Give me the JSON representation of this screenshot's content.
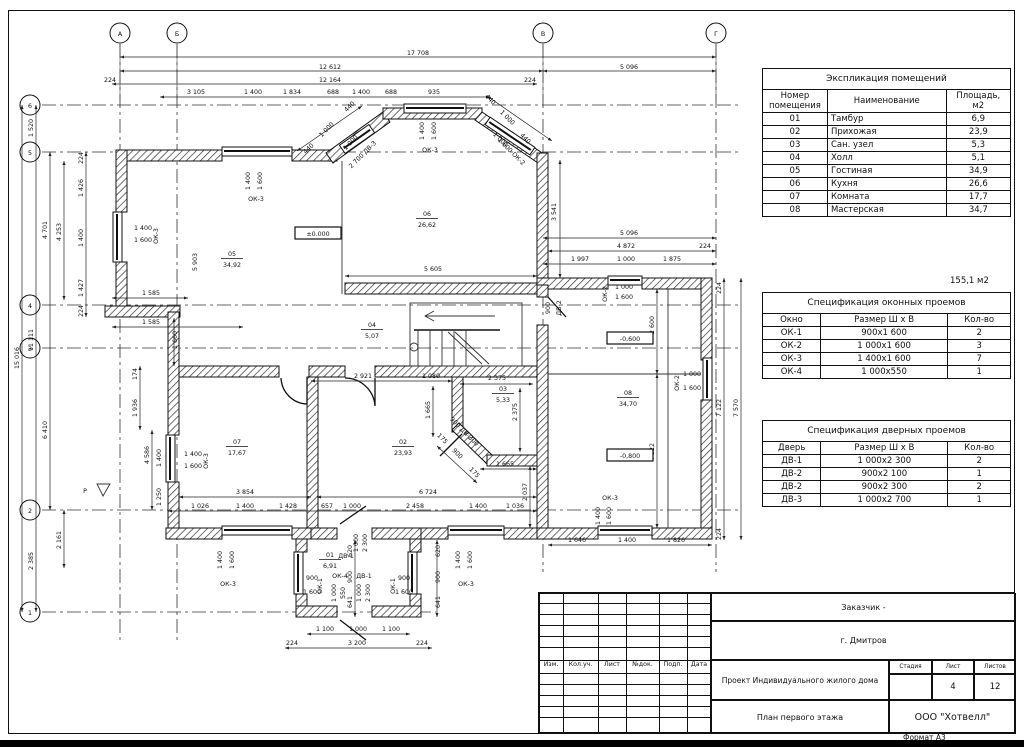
{
  "meta": {
    "format_label": "Формат А3"
  },
  "tables": {
    "rooms": {
      "title": "Экспликация помещений",
      "headers": [
        "Номер помещения",
        "Наименование",
        "Площадь, м2"
      ],
      "rows": [
        [
          "01",
          "Тамбур",
          "6,9"
        ],
        [
          "02",
          "Прихожая",
          "23,9"
        ],
        [
          "03",
          "Сан. узел",
          "5,3"
        ],
        [
          "04",
          "Холл",
          "5,1"
        ],
        [
          "05",
          "Гостиная",
          "34,9"
        ],
        [
          "06",
          "Кухня",
          "26,6"
        ],
        [
          "07",
          "Комната",
          "17,7"
        ],
        [
          "08",
          "Мастерская",
          "34,7"
        ]
      ],
      "total": "155,1 м2"
    },
    "windows": {
      "title": "Спецификация оконных проемов",
      "headers": [
        "Окно",
        "Размер Ш х В",
        "Кол-во"
      ],
      "rows": [
        [
          "ОК-1",
          "900х1 600",
          "2"
        ],
        [
          "ОК-2",
          "1 000х1 600",
          "3"
        ],
        [
          "ОК-3",
          "1 400х1 600",
          "7"
        ],
        [
          "ОК-4",
          "1 000х550",
          "1"
        ]
      ]
    },
    "doors": {
      "title": "Спецификация дверных проемов",
      "headers": [
        "Дверь",
        "Размер Ш х В",
        "Кол-во"
      ],
      "rows": [
        [
          "ДВ-1",
          "1 000х2 300",
          "2"
        ],
        [
          "ДВ-2",
          "900х2 100",
          "1"
        ],
        [
          "ДВ-2",
          "900х2 300",
          "2"
        ],
        [
          "ДВ-3",
          "1 000х2 700",
          "1"
        ]
      ]
    }
  },
  "titleblock": {
    "customer": "Заказчик -",
    "city": "г. Дмитров",
    "project": "Проект Индивидуального жилого дома",
    "sheet_title": "План первого этажа",
    "company": "ООО \"Хотвелл\"",
    "rev_cols": [
      "Изм.",
      "Кол.уч.",
      "Лист",
      "№док.",
      "Подп.",
      "Дата"
    ],
    "stage_headers": [
      "Стадия",
      "Лист",
      "Листов"
    ],
    "stage": "",
    "sheet_no": "4",
    "sheets_total": "12"
  },
  "plan": {
    "labels": [
      {
        "t": "А",
        "x": 120,
        "y": 36,
        "fs": 7.5
      },
      {
        "t": "Б",
        "x": 177,
        "y": 36,
        "fs": 7.5
      },
      {
        "t": "В",
        "x": 543,
        "y": 36,
        "fs": 7.5
      },
      {
        "t": "Г",
        "x": 716,
        "y": 36,
        "fs": 7.5
      },
      {
        "t": "6",
        "x": 30,
        "y": 108,
        "fs": 7.5
      },
      {
        "t": "5",
        "x": 30,
        "y": 155,
        "fs": 7.5
      },
      {
        "t": "4",
        "x": 30,
        "y": 308,
        "fs": 7.5
      },
      {
        "t": "3",
        "x": 30,
        "y": 351,
        "fs": 7.5
      },
      {
        "t": "2",
        "x": 30,
        "y": 513,
        "fs": 7.5
      },
      {
        "t": "1",
        "x": 30,
        "y": 615,
        "fs": 7.5
      },
      {
        "t": "17 708",
        "x": 418,
        "y": 55
      },
      {
        "t": "12 612",
        "x": 330,
        "y": 69
      },
      {
        "t": "5 096",
        "x": 629,
        "y": 69
      },
      {
        "t": "224",
        "x": 110,
        "y": 82
      },
      {
        "t": "12 164",
        "x": 330,
        "y": 82
      },
      {
        "t": "224",
        "x": 530,
        "y": 82
      },
      {
        "t": "3 105",
        "x": 196,
        "y": 94
      },
      {
        "t": "1 400",
        "x": 253,
        "y": 94
      },
      {
        "t": "1 834",
        "x": 292,
        "y": 94
      },
      {
        "t": "688",
        "x": 333,
        "y": 94
      },
      {
        "t": "1 400",
        "x": 361,
        "y": 94
      },
      {
        "t": "688",
        "x": 391,
        "y": 94
      },
      {
        "t": "935",
        "x": 434,
        "y": 94
      },
      {
        "t": "1 520",
        "x": 33,
        "y": 128,
        "r": -90
      },
      {
        "t": "15 016",
        "x": 19,
        "y": 358,
        "r": -90
      },
      {
        "t": "11 111",
        "x": 33,
        "y": 340,
        "r": -90
      },
      {
        "t": "4 701",
        "x": 47,
        "y": 230,
        "r": -90
      },
      {
        "t": "6 410",
        "x": 47,
        "y": 430,
        "r": -90
      },
      {
        "t": "2 385",
        "x": 33,
        "y": 561,
        "r": -90
      },
      {
        "t": "2 161",
        "x": 61,
        "y": 540,
        "r": -90
      },
      {
        "t": "4 253",
        "x": 61,
        "y": 232,
        "r": -90
      },
      {
        "t": "224",
        "x": 83,
        "y": 158,
        "r": -90
      },
      {
        "t": "1 426",
        "x": 83,
        "y": 188,
        "r": -90
      },
      {
        "t": "1 400",
        "x": 83,
        "y": 238,
        "r": -90
      },
      {
        "t": "1 427",
        "x": 83,
        "y": 288,
        "r": -90
      },
      {
        "t": "224",
        "x": 83,
        "y": 311,
        "r": -90
      },
      {
        "t": "1 585",
        "x": 151,
        "y": 295
      },
      {
        "t": "1 585",
        "x": 151,
        "y": 324
      },
      {
        "t": "5 903",
        "x": 197,
        "y": 262,
        "r": -90
      },
      {
        "t": "1 660",
        "x": 177,
        "y": 340,
        "r": -90
      },
      {
        "t": "174",
        "x": 137,
        "y": 374,
        "r": -90
      },
      {
        "t": "1 936",
        "x": 137,
        "y": 408,
        "r": -90
      },
      {
        "t": "4 586",
        "x": 149,
        "y": 455,
        "r": -90
      },
      {
        "t": "1 400",
        "x": 161,
        "y": 458,
        "r": -90
      },
      {
        "t": "1 250",
        "x": 161,
        "y": 497,
        "r": -90
      },
      {
        "t": "3 541",
        "x": 556,
        "y": 212,
        "r": -90
      },
      {
        "t": "5 096",
        "x": 629,
        "y": 235
      },
      {
        "t": "4 872",
        "x": 626,
        "y": 248
      },
      {
        "t": "224",
        "x": 705,
        "y": 248
      },
      {
        "t": "1 997",
        "x": 580,
        "y": 261
      },
      {
        "t": "1 000",
        "x": 626,
        "y": 261
      },
      {
        "t": "1 875",
        "x": 672,
        "y": 261
      },
      {
        "t": "2 600",
        "x": 654,
        "y": 325,
        "r": -90
      },
      {
        "t": "4 522",
        "x": 654,
        "y": 452,
        "r": -90
      },
      {
        "t": "7 122",
        "x": 721,
        "y": 408,
        "r": -90
      },
      {
        "t": "7 570",
        "x": 738,
        "y": 408,
        "r": -90
      },
      {
        "t": "224",
        "x": 721,
        "y": 288,
        "r": -90
      },
      {
        "t": "224",
        "x": 721,
        "y": 534,
        "r": -90
      },
      {
        "t": "1 646",
        "x": 577,
        "y": 542
      },
      {
        "t": "1 400",
        "x": 627,
        "y": 542
      },
      {
        "t": "1 826",
        "x": 676,
        "y": 542
      },
      {
        "t": "5 605",
        "x": 433,
        "y": 271
      },
      {
        "t": "2 921",
        "x": 363,
        "y": 378
      },
      {
        "t": "1 080",
        "x": 431,
        "y": 378
      },
      {
        "t": "1 665",
        "x": 430,
        "y": 410,
        "r": -90
      },
      {
        "t": "2 375",
        "x": 497,
        "y": 380
      },
      {
        "t": "2 375",
        "x": 517,
        "y": 412,
        "r": -90
      },
      {
        "t": "1 665",
        "x": 505,
        "y": 466
      },
      {
        "t": "2 037",
        "x": 527,
        "y": 492,
        "r": -90
      },
      {
        "t": "3 854",
        "x": 245,
        "y": 494
      },
      {
        "t": "6 724",
        "x": 428,
        "y": 494
      },
      {
        "t": "1 026",
        "x": 200,
        "y": 508
      },
      {
        "t": "1 400",
        "x": 245,
        "y": 508
      },
      {
        "t": "1 428",
        "x": 288,
        "y": 508
      },
      {
        "t": "657",
        "x": 327,
        "y": 508
      },
      {
        "t": "1 000",
        "x": 352,
        "y": 508
      },
      {
        "t": "2 458",
        "x": 415,
        "y": 508
      },
      {
        "t": "1 400",
        "x": 478,
        "y": 508
      },
      {
        "t": "1 036",
        "x": 515,
        "y": 508
      },
      {
        "t": "620",
        "x": 352,
        "y": 551,
        "r": -90
      },
      {
        "t": "900",
        "x": 352,
        "y": 577,
        "r": -90
      },
      {
        "t": "641",
        "x": 352,
        "y": 602,
        "r": -90
      },
      {
        "t": "620",
        "x": 440,
        "y": 551,
        "r": -90
      },
      {
        "t": "900",
        "x": 440,
        "y": 577,
        "r": -90
      },
      {
        "t": "641",
        "x": 440,
        "y": 602,
        "r": -90
      },
      {
        "t": "1 100",
        "x": 325,
        "y": 631
      },
      {
        "t": "1 000",
        "x": 358,
        "y": 631
      },
      {
        "t": "1 100",
        "x": 391,
        "y": 631
      },
      {
        "t": "224",
        "x": 292,
        "y": 645
      },
      {
        "t": "3 200",
        "x": 357,
        "y": 645
      },
      {
        "t": "224",
        "x": 422,
        "y": 645
      },
      {
        "t": "05",
        "x": 232,
        "y": 256,
        "fs": 7.5,
        "u": 1
      },
      {
        "t": "34,92",
        "x": 232,
        "y": 267,
        "fs": 7.5
      },
      {
        "t": "06",
        "x": 427,
        "y": 216,
        "fs": 7.5,
        "u": 1
      },
      {
        "t": "26,62",
        "x": 427,
        "y": 227,
        "fs": 7.5
      },
      {
        "t": "04",
        "x": 372,
        "y": 327,
        "fs": 7.5,
        "u": 1
      },
      {
        "t": "5,07",
        "x": 372,
        "y": 338,
        "fs": 7.5
      },
      {
        "t": "07",
        "x": 237,
        "y": 444,
        "fs": 7.5,
        "u": 1
      },
      {
        "t": "17,67",
        "x": 237,
        "y": 455,
        "fs": 7.5
      },
      {
        "t": "02",
        "x": 403,
        "y": 444,
        "fs": 7.5,
        "u": 1
      },
      {
        "t": "23,93",
        "x": 403,
        "y": 455,
        "fs": 7.5
      },
      {
        "t": "03",
        "x": 503,
        "y": 391,
        "fs": 7.5,
        "u": 1
      },
      {
        "t": "5,33",
        "x": 503,
        "y": 402,
        "fs": 7.5
      },
      {
        "t": "08",
        "x": 628,
        "y": 395,
        "fs": 7.5,
        "u": 1
      },
      {
        "t": "34,70",
        "x": 628,
        "y": 406,
        "fs": 7.5
      },
      {
        "t": "01",
        "x": 330,
        "y": 557,
        "fs": 7.5,
        "u": 1
      },
      {
        "t": "6,91",
        "x": 330,
        "y": 568,
        "fs": 7.5
      },
      {
        "t": "±0.000",
        "x": 318,
        "y": 236,
        "box": 1
      },
      {
        "t": "-0,600",
        "x": 630,
        "y": 341,
        "box": 1
      },
      {
        "t": "-0,800",
        "x": 630,
        "y": 458,
        "box": 1
      },
      {
        "t": "1 400",
        "x": 143,
        "y": 230
      },
      {
        "t": "1 600",
        "x": 143,
        "y": 242
      },
      {
        "t": "ОК-3",
        "x": 158,
        "y": 236,
        "r": -90
      },
      {
        "t": "1 400",
        "x": 250,
        "y": 181,
        "r": -90
      },
      {
        "t": "1 600",
        "x": 262,
        "y": 181,
        "r": -90
      },
      {
        "t": "ОК-3",
        "x": 256,
        "y": 201
      },
      {
        "t": "1 400",
        "x": 424,
        "y": 131,
        "r": -90
      },
      {
        "t": "1 600",
        "x": 436,
        "y": 131,
        "r": -90
      },
      {
        "t": "ОК-3",
        "x": 430,
        "y": 152
      },
      {
        "t": "440",
        "x": 310,
        "y": 150,
        "r": -45
      },
      {
        "t": "1 000",
        "x": 328,
        "y": 131,
        "r": -45
      },
      {
        "t": "440",
        "x": 351,
        "y": 108,
        "r": -45
      },
      {
        "t": "1 000",
        "x": 352,
        "y": 144,
        "r": -45
      },
      {
        "t": "2 700 ДВ-3",
        "x": 364,
        "y": 156,
        "r": -45
      },
      {
        "t": "440",
        "x": 489,
        "y": 101,
        "r": 45
      },
      {
        "t": "1 000",
        "x": 506,
        "y": 119,
        "r": 45
      },
      {
        "t": "440",
        "x": 524,
        "y": 140,
        "r": 45
      },
      {
        "t": "1 000",
        "x": 499,
        "y": 141,
        "r": 45
      },
      {
        "t": "1 600 ОК-2",
        "x": 510,
        "y": 153,
        "r": 45
      },
      {
        "t": "1 000",
        "x": 624,
        "y": 289
      },
      {
        "t": "1 600",
        "x": 624,
        "y": 299
      },
      {
        "t": "ОК-2",
        "x": 607,
        "y": 294,
        "r": -90
      },
      {
        "t": "ОК-2",
        "x": 679,
        "y": 383,
        "r": -90
      },
      {
        "t": "1 000",
        "x": 692,
        "y": 376
      },
      {
        "t": "1 600",
        "x": 692,
        "y": 390
      },
      {
        "t": "ОК-3",
        "x": 610,
        "y": 500
      },
      {
        "t": "1 400",
        "x": 600,
        "y": 516,
        "r": -90
      },
      {
        "t": "1 600",
        "x": 611,
        "y": 516,
        "r": -90
      },
      {
        "t": "900",
        "x": 550,
        "y": 308,
        "r": -90
      },
      {
        "t": "ДВ-2",
        "x": 561,
        "y": 308,
        "r": -90
      },
      {
        "t": "1 400",
        "x": 193,
        "y": 456
      },
      {
        "t": "1 600",
        "x": 193,
        "y": 468
      },
      {
        "t": "ОК-3",
        "x": 208,
        "y": 461,
        "r": -90
      },
      {
        "t": "1 400",
        "x": 222,
        "y": 560,
        "r": -90
      },
      {
        "t": "1 600",
        "x": 234,
        "y": 560,
        "r": -90
      },
      {
        "t": "ОК-3",
        "x": 228,
        "y": 586
      },
      {
        "t": "1 400",
        "x": 460,
        "y": 560,
        "r": -90
      },
      {
        "t": "1 600",
        "x": 472,
        "y": 560,
        "r": -90
      },
      {
        "t": "ОК-3",
        "x": 466,
        "y": 586
      },
      {
        "t": "900",
        "x": 312,
        "y": 580
      },
      {
        "t": "1 600",
        "x": 312,
        "y": 594
      },
      {
        "t": "ОК-1",
        "x": 322,
        "y": 586,
        "r": -90
      },
      {
        "t": "900",
        "x": 404,
        "y": 580
      },
      {
        "t": "1 600",
        "x": 404,
        "y": 594
      },
      {
        "t": "ОК-1",
        "x": 395,
        "y": 586,
        "r": -90
      },
      {
        "t": "ОК-4",
        "x": 340,
        "y": 578
      },
      {
        "t": "1 000",
        "x": 336,
        "y": 593,
        "r": -90
      },
      {
        "t": "550",
        "x": 345,
        "y": 593,
        "r": -90
      },
      {
        "t": "ДВ-1",
        "x": 364,
        "y": 578
      },
      {
        "t": "1 000",
        "x": 361,
        "y": 593,
        "r": -90
      },
      {
        "t": "2 300",
        "x": 370,
        "y": 593,
        "r": -90
      },
      {
        "t": "ДВ-1",
        "x": 346,
        "y": 558
      },
      {
        "t": "1 000",
        "x": 358,
        "y": 543,
        "r": -90
      },
      {
        "t": "2 300",
        "x": 367,
        "y": 543,
        "r": -90
      },
      {
        "t": "175",
        "x": 441,
        "y": 440,
        "r": 45
      },
      {
        "t": "900",
        "x": 456,
        "y": 455,
        "r": 45
      },
      {
        "t": "175",
        "x": 473,
        "y": 474,
        "r": 45
      },
      {
        "t": "900 ДВ-2",
        "x": 460,
        "y": 430,
        "r": 45
      },
      {
        "t": "2 300",
        "x": 470,
        "y": 440,
        "r": 45
      },
      {
        "t": "Р",
        "x": 85,
        "y": 493,
        "fs": 10
      }
    ]
  }
}
